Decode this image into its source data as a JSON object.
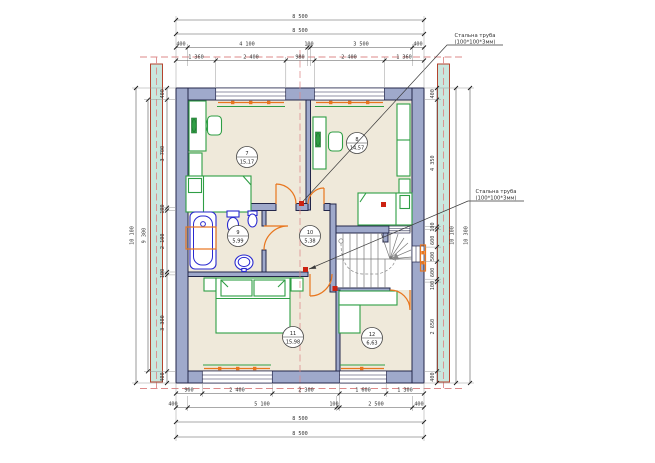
{
  "annotations": {
    "steel_pipe_top": {
      "line1": "Стальна труба",
      "line2": "(100*100*3мм)"
    },
    "steel_pipe_mid": {
      "line1": "Стальна труба",
      "line2": "(100*100*3мм)"
    }
  },
  "rooms": {
    "r7": {
      "num": "7",
      "area": "15,17"
    },
    "r8": {
      "num": "8",
      "area": "14,57"
    },
    "r9": {
      "num": "9",
      "area": "5,99"
    },
    "r10": {
      "num": "10",
      "area": "5,38"
    },
    "r11": {
      "num": "11",
      "area": "15,98"
    },
    "r12": {
      "num": "12",
      "area": "6,63"
    }
  },
  "dims": {
    "top": {
      "overall1": "8 500",
      "overall2": "8 500",
      "chain1": [
        "400",
        "4 100",
        "100",
        "3 500",
        "400"
      ],
      "chain2": [
        "1 360",
        "2 400",
        "980",
        "2 400",
        "1 360"
      ]
    },
    "bottom": {
      "chain1": [
        "900",
        "2 400",
        "2 300",
        "1 600",
        "1 300"
      ],
      "chain2": [
        "400",
        "5 100",
        "100",
        "2 500",
        "400"
      ],
      "overall1": "8 500",
      "overall2": "8 500"
    },
    "left": {
      "chain": [
        "400",
        "3 700",
        "100",
        "2 100",
        "100",
        "3 300",
        "400"
      ],
      "inner": "9 300",
      "overall": "10 100"
    },
    "right": {
      "chain": [
        "400",
        "4 350",
        "100",
        "600",
        "500",
        "600",
        "100",
        "2 650",
        "400"
      ],
      "inner": "10 100",
      "overall": "10 300"
    }
  },
  "colors": {
    "wall_fill": "#9fa9cb",
    "wall_stroke": "#23264a",
    "floor": "#efe9da",
    "furniture_green": "#2f9e44",
    "plumbing_blue": "#2a2ad0",
    "heating_orange": "#e8761e",
    "column_red": "#cc2211",
    "axis_pink": "#dc8a8a",
    "pipe_strip_fill": "#c9e7de",
    "pipe_strip_stroke": "#b5432e",
    "dim_text": "#333333"
  }
}
